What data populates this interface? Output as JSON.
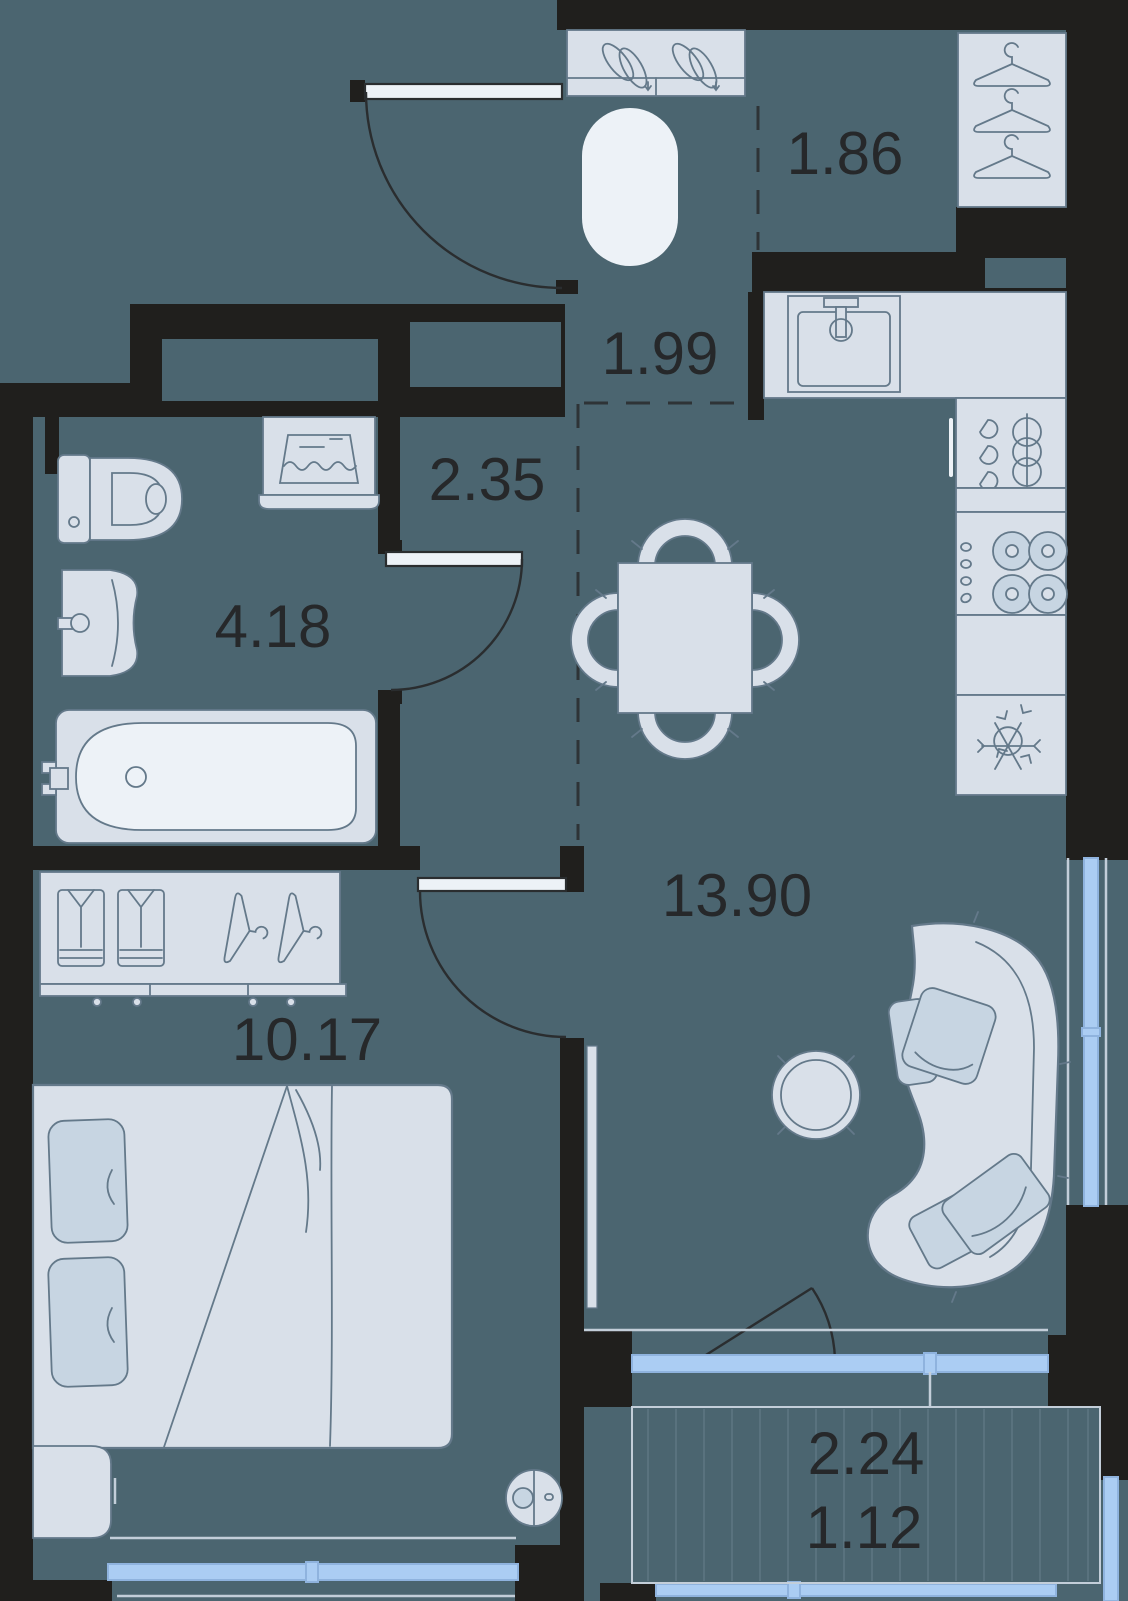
{
  "rooms": {
    "wardrobe": {
      "area": "1.86"
    },
    "hallway": {
      "area": "1.99"
    },
    "corridor": {
      "area": "2.35"
    },
    "bathroom": {
      "area": "4.18"
    },
    "kitchen_living": {
      "area": "13.90"
    },
    "bedroom": {
      "area": "10.17"
    },
    "balcony": {
      "area_total": "2.24",
      "area_reduced": "1.12"
    }
  },
  "icons": [
    "entrance-door-icon",
    "shoe-cabinet-icon",
    "rug-icon",
    "hanger-icon",
    "kitchen-sink-icon",
    "dish-rack-icon",
    "stove-icon",
    "fridge-snowflake-icon",
    "dining-table-icon",
    "chair-icon",
    "toilet-icon",
    "washing-machine-icon",
    "bathroom-sink-icon",
    "bathtub-icon",
    "shirt-icon",
    "bed-icon",
    "pillow-icon",
    "nightstand-icon",
    "robot-vacuum-icon",
    "sofa-icon",
    "coffee-table-icon",
    "tv-console-icon",
    "balcony-door-icon",
    "window-icon"
  ],
  "theme": {
    "floor": "#4b6570",
    "wall": "#201f1d",
    "furn": "#d9e0e9",
    "furnline": "#64798a",
    "furnlight": "#edf2f7",
    "pillow": "#c7d5e2",
    "window": "#abcdf3",
    "windowframe": "#8fb3de",
    "sill": "#c3ced9",
    "stripe": "#5d7681",
    "dash": "#2e3336",
    "door": "#2a2d2f",
    "label": "#26282a"
  }
}
